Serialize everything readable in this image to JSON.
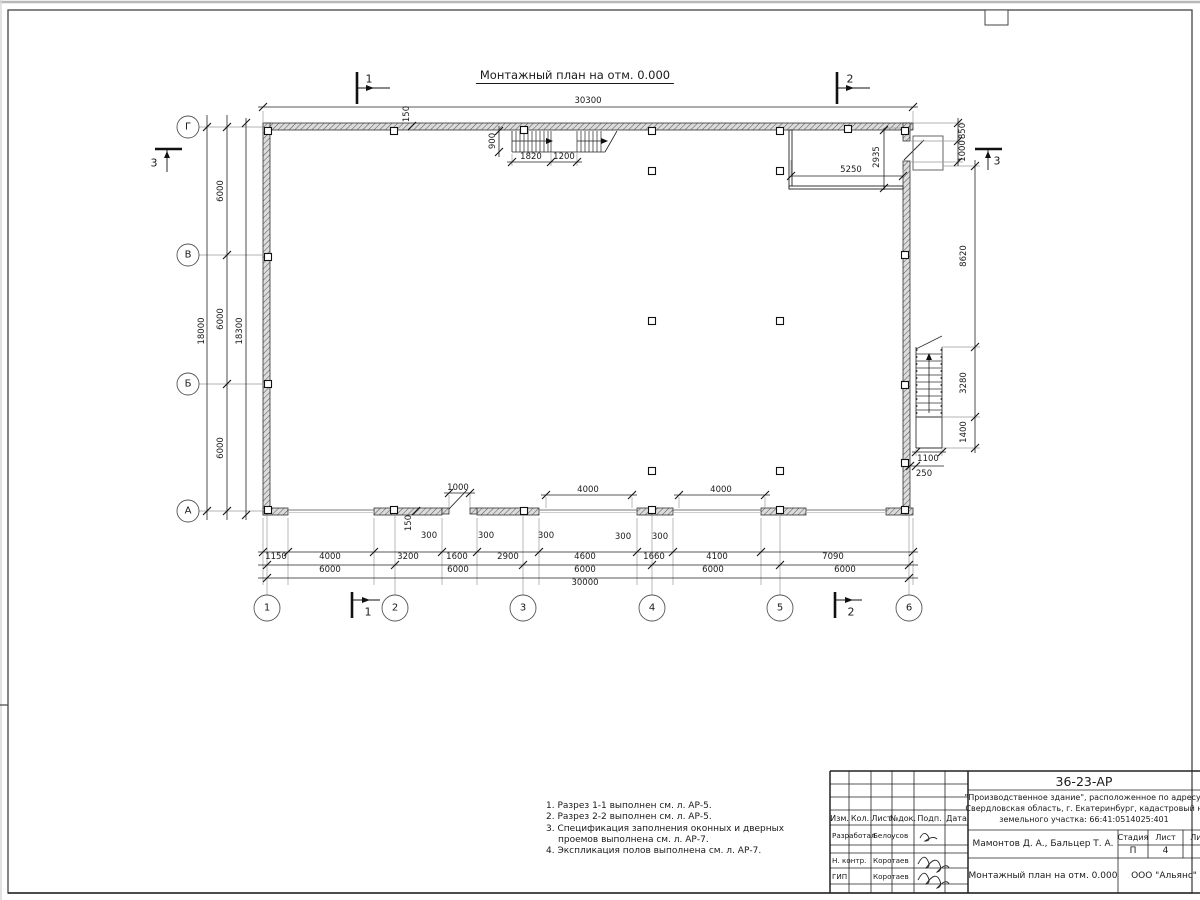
{
  "title": "Монтажный план на отм. 0.000",
  "plan": {
    "axis_rows": [
      {
        "t": "Г",
        "x": 188,
        "y": 127
      },
      {
        "t": "В",
        "x": 188,
        "y": 255
      },
      {
        "t": "Б",
        "x": 188,
        "y": 384
      },
      {
        "t": "А",
        "x": 188,
        "y": 511
      }
    ],
    "axis_cols": [
      {
        "t": "1",
        "x": 267,
        "y": 608
      },
      {
        "t": "2",
        "x": 395,
        "y": 608
      },
      {
        "t": "3",
        "x": 523,
        "y": 608
      },
      {
        "t": "4",
        "x": 652,
        "y": 608
      },
      {
        "t": "5",
        "x": 780,
        "y": 608
      },
      {
        "t": "6",
        "x": 909,
        "y": 608
      }
    ],
    "sections": [
      {
        "t": "1",
        "x": 369,
        "y": 79
      },
      {
        "t": "2",
        "x": 850,
        "y": 79
      },
      {
        "t": "1",
        "x": 368,
        "y": 612
      },
      {
        "t": "2",
        "x": 851,
        "y": 612
      },
      {
        "t": "3",
        "x": 154,
        "y": 163
      },
      {
        "t": "3",
        "x": 997,
        "y": 161
      }
    ],
    "dims": [
      {
        "t": "30300",
        "x": 588,
        "y": 101
      },
      {
        "t": "150",
        "x": 407,
        "y": 114,
        "r": 1
      },
      {
        "t": "900",
        "x": 493,
        "y": 141,
        "r": 1
      },
      {
        "t": "1820",
        "x": 531,
        "y": 157
      },
      {
        "t": "1200",
        "x": 564,
        "y": 157
      },
      {
        "t": "5250",
        "x": 851,
        "y": 170
      },
      {
        "t": "2935",
        "x": 877,
        "y": 157,
        "r": 1
      },
      {
        "t": "850",
        "x": 963,
        "y": 131,
        "r": 1
      },
      {
        "t": "1000",
        "x": 963,
        "y": 151,
        "r": 1
      },
      {
        "t": "8620",
        "x": 964,
        "y": 256,
        "r": 1
      },
      {
        "t": "3280",
        "x": 964,
        "y": 383,
        "r": 1
      },
      {
        "t": "1400",
        "x": 964,
        "y": 432,
        "r": 1
      },
      {
        "t": "1100",
        "x": 928,
        "y": 459
      },
      {
        "t": "250",
        "x": 924,
        "y": 474
      },
      {
        "t": "6000",
        "x": 221,
        "y": 191,
        "r": 1
      },
      {
        "t": "6000",
        "x": 221,
        "y": 319,
        "r": 1
      },
      {
        "t": "6000",
        "x": 221,
        "y": 448,
        "r": 1
      },
      {
        "t": "18000",
        "x": 202,
        "y": 331,
        "r": 1
      },
      {
        "t": "18300",
        "x": 240,
        "y": 331,
        "r": 1
      },
      {
        "t": "1000",
        "x": 458,
        "y": 488
      },
      {
        "t": "4000",
        "x": 588,
        "y": 490
      },
      {
        "t": "4000",
        "x": 721,
        "y": 490
      },
      {
        "t": "150",
        "x": 409,
        "y": 523,
        "r": 1
      },
      {
        "t": "300",
        "x": 429,
        "y": 536
      },
      {
        "t": "300",
        "x": 486,
        "y": 536
      },
      {
        "t": "300",
        "x": 546,
        "y": 536
      },
      {
        "t": "300",
        "x": 623,
        "y": 537
      },
      {
        "t": "300",
        "x": 660,
        "y": 537
      },
      {
        "t": "1150",
        "x": 276,
        "y": 557
      },
      {
        "t": "4000",
        "x": 330,
        "y": 557
      },
      {
        "t": "3200",
        "x": 408,
        "y": 557
      },
      {
        "t": "1600",
        "x": 457,
        "y": 557
      },
      {
        "t": "2900",
        "x": 508,
        "y": 557
      },
      {
        "t": "4600",
        "x": 585,
        "y": 557
      },
      {
        "t": "1660",
        "x": 654,
        "y": 557
      },
      {
        "t": "4100",
        "x": 717,
        "y": 557
      },
      {
        "t": "7090",
        "x": 833,
        "y": 557
      },
      {
        "t": "6000",
        "x": 330,
        "y": 570
      },
      {
        "t": "6000",
        "x": 458,
        "y": 570
      },
      {
        "t": "6000",
        "x": 585,
        "y": 570
      },
      {
        "t": "6000",
        "x": 713,
        "y": 570
      },
      {
        "t": "6000",
        "x": 845,
        "y": 570
      },
      {
        "t": "30000",
        "x": 585,
        "y": 583
      }
    ],
    "notes": {
      "x": 546,
      "y": 801,
      "lines": [
        {
          "t": "1. Разрез 1-1 выполнен см. л. АР-5.",
          "i": 0
        },
        {
          "t": "2. Разрез 2-2 выполнен см. л. АР-5.",
          "i": 0
        },
        {
          "t": "3. Спецификация заполнения оконных и дверных",
          "i": 0
        },
        {
          "t": "проемов выполнена см. л. АР-7.",
          "i": 1
        },
        {
          "t": "4. Экспликация полов выполнена см. л. АР-7.",
          "i": 0
        }
      ]
    }
  },
  "titleblock": {
    "code": "36-23-АР",
    "address_lines": [
      "\"Производственное здание\", расположенное по адресу:",
      "Свердловская область, г. Екатеринбург, кадастровый н",
      "земельного участка: 66:41:0514025:401"
    ],
    "col_headers": [
      "Изм.",
      "Кол.",
      "Лист",
      "№док.",
      "Подп.",
      "Дата"
    ],
    "rows": [
      {
        "role": "Разработал",
        "name": "Белоусов"
      },
      {
        "role": "Н. контр.",
        "name": "Коротаев"
      },
      {
        "role": "ГИП",
        "name": "Коротаев"
      }
    ],
    "authors": "Мамонтов Д. А., Бальцер Т. А.",
    "stage_label": "Стадия",
    "sheet_label": "Лист",
    "sheets_label": "Лис",
    "stage": "П",
    "sheet": "4",
    "drawing_title": "Монтажный план на отм. 0.000",
    "company": "ООО \"Альянс\""
  }
}
